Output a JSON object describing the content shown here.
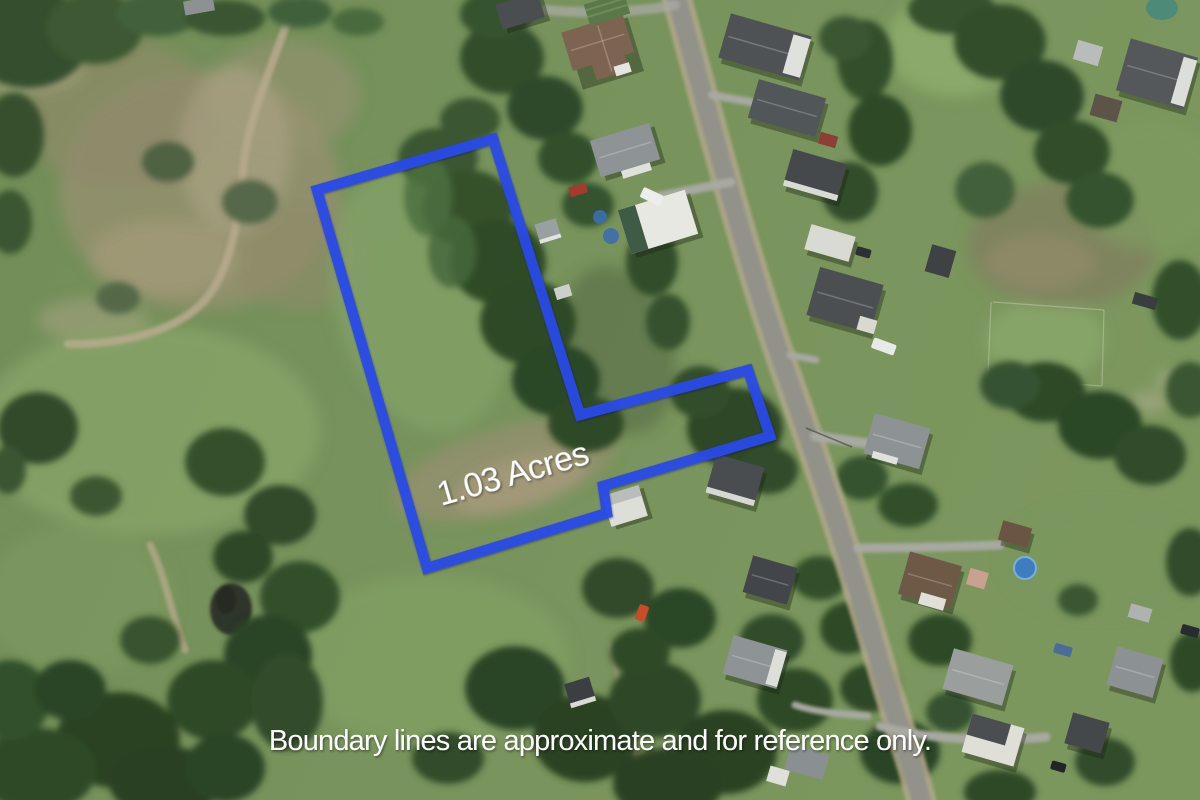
{
  "map_overlay": {
    "area_label": "1.03 Acres",
    "disclaimer": "Boundary lines are approximate and for reference only.",
    "boundary_points": "317,190 493,139 580,415 748,370 770,436 603,486 607,513 427,568",
    "boundary_color": "#2b4ae6",
    "label_color": "#ffffff"
  },
  "scene": {
    "type": "aerial-photograph",
    "palette": {
      "field_green": "#75905a",
      "tree_green": "#2f4a28",
      "road_gray": "#92918a",
      "dirt_tan": "#b4a88c"
    }
  }
}
